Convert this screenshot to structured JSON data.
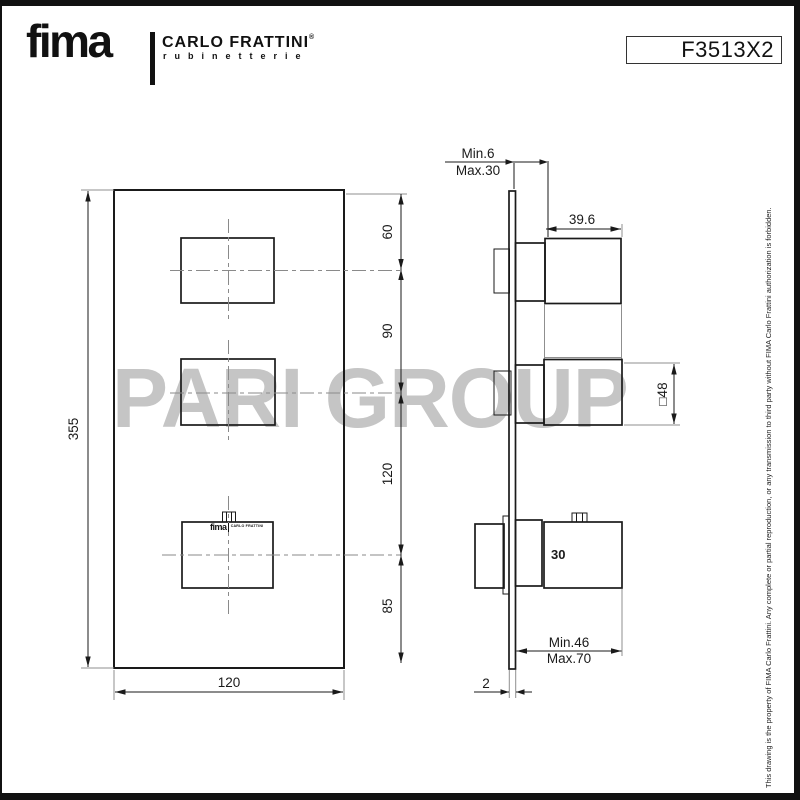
{
  "header": {
    "brand": "fima",
    "brand_subtitle": "CARLO FRATTINI",
    "brand_reg": "®",
    "brand_tagline": "rubinetterie",
    "product_code": "F3513X2"
  },
  "watermark": {
    "text": "PARI GROUP",
    "color": "#c5c5c5"
  },
  "front_view": {
    "height_label": "355",
    "width_label": "120",
    "segments": [
      "60",
      "90",
      "120",
      "85"
    ],
    "handle_logo": {
      "brand": "fima",
      "sub": "CARLO FRATTINI"
    }
  },
  "side_view": {
    "top_min": "Min.6",
    "top_max": "Max.30",
    "projection": "39.6",
    "handle_square": "□48",
    "knob_label": "30",
    "bottom_min": "Min.46",
    "bottom_max": "Max.70",
    "plate_thickness": "2"
  },
  "footer_note": "This drawing is the property of FIMA Carlo Frattini. Any complete or partial reproduction, or any transmission to third party without FIMA Carlo Frattini authorization is forbidden.",
  "colors": {
    "line": "#1a1a1a",
    "extension_line": "#8f8f8f",
    "watermark": "#c5c5c5"
  }
}
